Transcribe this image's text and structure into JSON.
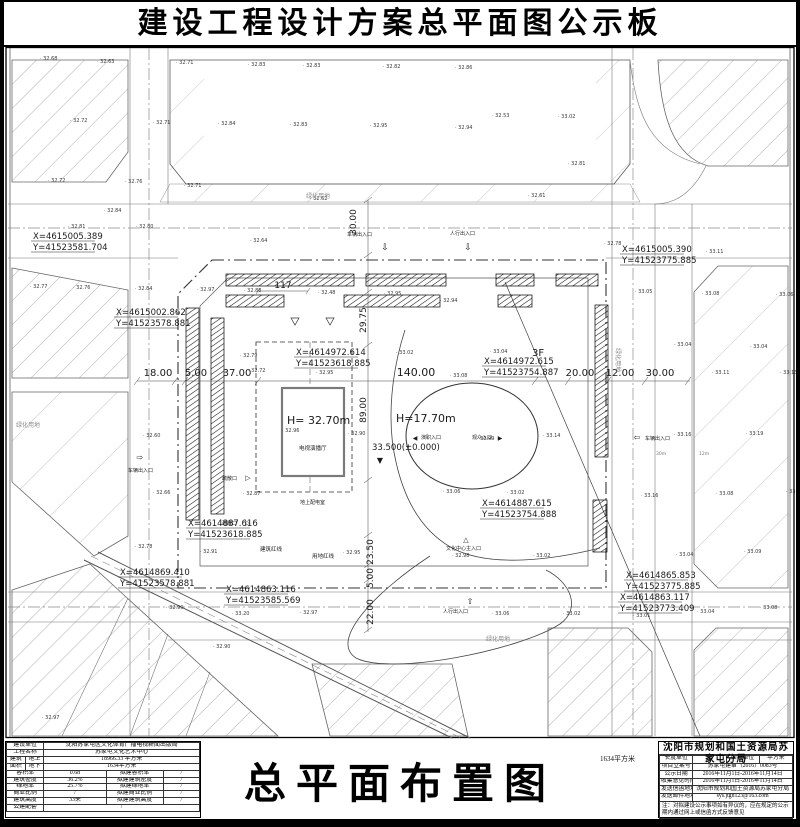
{
  "page": {
    "board_title": "建设工程设计方案总平面图公示板",
    "drawing_title": "总平面布置图",
    "stray_area_note": "1634平方米"
  },
  "left_table": {
    "rows": [
      {
        "cells": [
          {
            "t": "建设单位",
            "w": 2
          },
          {
            "t": "沈阳苏家屯区文化体育广播电视新闻出版局",
            "w": 3
          }
        ]
      },
      {
        "cells": [
          {
            "t": "工程名称",
            "w": 2
          },
          {
            "t": "苏家屯文化艺术中心",
            "w": 3
          }
        ]
      },
      {
        "cells": [
          {
            "t": "建筑",
            "w": 1
          },
          {
            "t": "地上",
            "w": 1
          },
          {
            "t": "18966.33 平方米",
            "w": 3
          }
        ]
      },
      {
        "cells": [
          {
            "t": "面积",
            "w": 1
          },
          {
            "t": "地下",
            "w": 1
          },
          {
            "t": "1634平方米",
            "w": 3
          }
        ]
      },
      {
        "cells": [
          {
            "t": "容积率",
            "w": 2
          },
          {
            "t": "0.68",
            "w": 1
          },
          {
            "t": "拟建容积率",
            "w": 1
          },
          {
            "t": "/",
            "w": 1
          }
        ]
      },
      {
        "cells": [
          {
            "t": "建筑密度",
            "w": 2
          },
          {
            "t": "36.2%",
            "w": 1
          },
          {
            "t": "拟建建筑密度",
            "w": 1
          },
          {
            "t": "/",
            "w": 1
          }
        ]
      },
      {
        "cells": [
          {
            "t": "绿地率",
            "w": 2
          },
          {
            "t": "25.7%",
            "w": 1
          },
          {
            "t": "拟建绿地率",
            "w": 1
          },
          {
            "t": "/",
            "w": 1
          }
        ]
      },
      {
        "cells": [
          {
            "t": "商业比例",
            "w": 2
          },
          {
            "t": "/",
            "w": 1
          },
          {
            "t": "拟建商业比例",
            "w": 1
          },
          {
            "t": "/",
            "w": 1
          }
        ]
      },
      {
        "cells": [
          {
            "t": "建筑高度",
            "w": 2
          },
          {
            "t": "33米",
            "w": 1
          },
          {
            "t": "拟建建筑高度",
            "w": 1
          },
          {
            "t": "/",
            "w": 1
          }
        ]
      },
      {
        "cells": [
          {
            "t": "公建配套",
            "w": 2
          },
          {
            "t": "/",
            "w": 3
          }
        ]
      }
    ]
  },
  "right_table": {
    "agency": "沈阳市规划和国土资源局苏家屯分局",
    "rows": [
      {
        "cells": [
          {
            "t": "长度单位",
            "w": 1
          },
          {
            "t": "米",
            "w": 1
          },
          {
            "t": "面积单位",
            "w": 1
          },
          {
            "t": "平方米",
            "w": 1
          }
        ]
      },
      {
        "cells": [
          {
            "t": "项目立案号",
            "w": 1
          },
          {
            "t": "苏家屯建审（2016）0083号",
            "w": 3
          }
        ]
      },
      {
        "cells": [
          {
            "t": "公示日期",
            "w": 1
          },
          {
            "t": "2016年11月1日-2016年11月14日",
            "w": 3
          }
        ]
      },
      {
        "cells": [
          {
            "t": "收集意见时间",
            "w": 1
          },
          {
            "t": "2016年11月1日-2016年11月14日",
            "w": 3
          }
        ]
      },
      {
        "cells": [
          {
            "t": "发送信函地址",
            "w": 1
          },
          {
            "t": "沈阳市规划和国土资源局苏家屯分局",
            "w": 3
          }
        ]
      },
      {
        "cells": [
          {
            "t": "发送邮件地址",
            "w": 1
          },
          {
            "t": "sys.jtgh123@163.com",
            "w": 3
          }
        ]
      }
    ],
    "note": "注：对拟建设公示事项如有异议的，应在规定的公示期内通过网上或信函方式反馈意见"
  },
  "site_plan": {
    "coordinate_callouts": [
      {
        "x": 33,
        "y": 239,
        "a": "X=4615005.389",
        "b": "Y=41523581.704"
      },
      {
        "x": 116,
        "y": 315,
        "a": "X=4615002.862",
        "b": "Y=41523578.881"
      },
      {
        "x": 296,
        "y": 355,
        "a": "X=4614972.614",
        "b": "Y=41523618.885"
      },
      {
        "x": 484,
        "y": 364,
        "a": "X=4614972.615",
        "b": "Y=41523754.887"
      },
      {
        "x": 622,
        "y": 252,
        "a": "X=4615005.390",
        "b": "Y=41523775.885"
      },
      {
        "x": 188,
        "y": 526,
        "a": "X=4614887.616",
        "b": "Y=41523618.885"
      },
      {
        "x": 120,
        "y": 575,
        "a": "X=4614869.410",
        "b": "Y=41523578.881"
      },
      {
        "x": 226,
        "y": 592,
        "a": "X=4614863.116",
        "b": "Y=41523585.569"
      },
      {
        "x": 482,
        "y": 506,
        "a": "X=4614887.615",
        "b": "Y=41523754.888"
      },
      {
        "x": 626,
        "y": 578,
        "a": "X=4614865.853",
        "b": "Y=41523775.885"
      },
      {
        "x": 620,
        "y": 600,
        "a": "X=4614863.117",
        "b": "Y=41523773.409"
      }
    ],
    "dimensions": [
      {
        "t": "18.00",
        "x": 158,
        "y": 376,
        "s": 10
      },
      {
        "t": "5.00",
        "x": 196,
        "y": 376,
        "s": 10
      },
      {
        "t": "37.00",
        "x": 237,
        "y": 376,
        "s": 10
      },
      {
        "t": "140.00",
        "x": 416,
        "y": 376,
        "s": 11
      },
      {
        "t": "20.00",
        "x": 580,
        "y": 376,
        "s": 10
      },
      {
        "t": "12.00",
        "x": 620,
        "y": 376,
        "s": 10
      },
      {
        "t": "30.00",
        "x": 660,
        "y": 376,
        "s": 10
      },
      {
        "t": "117",
        "x": 283,
        "y": 288,
        "s": 9
      },
      {
        "t": "30.00",
        "x": 356,
        "y": 222,
        "s": 9,
        "rot": -90
      },
      {
        "t": "29.75",
        "x": 366,
        "y": 320,
        "s": 9,
        "rot": -90
      },
      {
        "t": "89.00",
        "x": 366,
        "y": 410,
        "s": 9,
        "rot": -90
      },
      {
        "t": "23.50",
        "x": 373,
        "y": 552,
        "s": 9,
        "rot": -90
      },
      {
        "t": "5.00",
        "x": 373,
        "y": 578,
        "s": 9,
        "rot": -90
      },
      {
        "t": "22.00",
        "x": 373,
        "y": 612,
        "s": 9,
        "rot": -90
      }
    ],
    "labels": [
      {
        "t": "车辆出入口",
        "x": 347,
        "y": 236,
        "s": 5,
        "n": "vehicle-entrance-label",
        "icon": "⇩",
        "ix": 385,
        "iy": 250,
        "is": 9
      },
      {
        "t": "人行出入口",
        "x": 450,
        "y": 235,
        "s": 5,
        "n": "pedestrian-entrance-label",
        "icon": "⇩",
        "ix": 468,
        "iy": 250,
        "is": 9
      },
      {
        "t": "车辆出入口",
        "x": 128,
        "y": 472,
        "s": 5,
        "n": "vehicle-entrance-label",
        "icon": "⇨",
        "ix": 140,
        "iy": 460,
        "is": 8
      },
      {
        "t": "车辆出入口",
        "x": 645,
        "y": 440,
        "s": 5,
        "n": "vehicle-entrance-label",
        "icon": "⇦",
        "ix": 637,
        "iy": 440,
        "is": 8
      },
      {
        "t": "人行出入口",
        "x": 443,
        "y": 613,
        "s": 5,
        "n": "pedestrian-entrance-label",
        "icon": "⇧",
        "ix": 470,
        "iy": 604,
        "is": 8
      },
      {
        "t": "文化中心主入口",
        "x": 446,
        "y": 550,
        "s": 5,
        "n": "main-entrance-label",
        "icon": "△",
        "ix": 466,
        "iy": 542,
        "is": 7
      },
      {
        "t": "疏散口",
        "x": 222,
        "y": 480,
        "s": 5,
        "n": "evacuation-exit-label",
        "icon": "▷",
        "ix": 248,
        "iy": 480,
        "is": 7
      },
      {
        "t": "疏散口",
        "x": 222,
        "y": 525,
        "s": 5,
        "n": "evacuation-exit-label",
        "icon": "▷",
        "ix": 248,
        "iy": 525,
        "is": 7
      },
      {
        "t": "演职入口",
        "x": 421,
        "y": 439,
        "s": 5,
        "n": "performer-entrance-label",
        "icon": "◀",
        "ix": 415,
        "iy": 440,
        "is": 6
      },
      {
        "t": "观众入口",
        "x": 472,
        "y": 439,
        "s": 5,
        "n": "audience-entrance-label",
        "icon": "▶",
        "ix": 500,
        "iy": 440,
        "is": 6
      },
      {
        "t": "建筑红线",
        "x": 260,
        "y": 551,
        "s": 5.5,
        "n": "building-redline-label"
      },
      {
        "t": "用地红线",
        "x": 312,
        "y": 558,
        "s": 5.5,
        "n": "site-redline-label"
      },
      {
        "t": "绿化用地",
        "x": 306,
        "y": 198,
        "s": 6,
        "c": "#8c8c8c",
        "n": "green-land-label"
      },
      {
        "t": "绿化用地",
        "x": 16,
        "y": 427,
        "s": 6,
        "c": "#8c8c8c",
        "n": "green-land-label"
      },
      {
        "t": "绿化用地",
        "x": 616,
        "y": 348,
        "s": 6,
        "rot": 90,
        "c": "#8c8c8c",
        "n": "green-land-label"
      },
      {
        "t": "绿化用地",
        "x": 486,
        "y": 641,
        "s": 6,
        "c": "#8c8c8c",
        "n": "green-land-label"
      },
      {
        "t": "电视演播厅",
        "x": 299,
        "y": 450,
        "s": 5.5,
        "n": "studio-name-label"
      },
      {
        "t": "地上配电室",
        "x": 300,
        "y": 504,
        "s": 5,
        "n": "power-room-label"
      },
      {
        "t": "H= 32.70m",
        "x": 287,
        "y": 424,
        "s": 11,
        "n": "studio-height-label"
      },
      {
        "t": "H=17.70m",
        "x": 396,
        "y": 422,
        "s": 11,
        "n": "hall-height-label"
      },
      {
        "t": "33.500(±0.000)",
        "x": 372,
        "y": 450,
        "s": 8.5,
        "n": "level-label"
      },
      {
        "icon": "▼",
        "ix": 380,
        "iy": 463,
        "is": 8,
        "n": "level-marker"
      },
      {
        "t": "3F",
        "x": 532,
        "y": 356,
        "s": 10,
        "n": "floors-label"
      },
      {
        "t": "30m",
        "x": 656,
        "y": 455,
        "s": 4.5,
        "c": "#777",
        "n": "road-width-label"
      },
      {
        "t": "12m",
        "x": 699,
        "y": 455,
        "s": 4.5,
        "c": "#777",
        "n": "road-width-label"
      }
    ],
    "spot_elevations": [
      [
        40,
        60,
        "32.68"
      ],
      [
        97,
        63,
        "32.63"
      ],
      [
        70,
        122,
        "32.72"
      ],
      [
        48,
        182,
        "32.72"
      ],
      [
        125,
        183,
        "32.76"
      ],
      [
        68,
        228,
        "32.81"
      ],
      [
        136,
        228,
        "32.80"
      ],
      [
        30,
        288,
        "32.77"
      ],
      [
        73,
        289,
        "32.76"
      ],
      [
        135,
        290,
        "32.84"
      ],
      [
        176,
        64,
        "32.71"
      ],
      [
        248,
        66,
        "32.83"
      ],
      [
        303,
        67,
        "32.83"
      ],
      [
        383,
        68,
        "32.82"
      ],
      [
        455,
        69,
        "32.86"
      ],
      [
        218,
        125,
        "32.84"
      ],
      [
        290,
        126,
        "32.83"
      ],
      [
        370,
        127,
        "32.95"
      ],
      [
        455,
        129,
        "32.94"
      ],
      [
        492,
        117,
        "32.53"
      ],
      [
        558,
        118,
        "33.02"
      ],
      [
        568,
        165,
        "32.81"
      ],
      [
        184,
        187,
        "32.71"
      ],
      [
        310,
        200,
        "32.62"
      ],
      [
        528,
        197,
        "32.61"
      ],
      [
        153,
        124,
        "32.71"
      ],
      [
        250,
        242,
        "32.64"
      ],
      [
        604,
        245,
        "32.78"
      ],
      [
        706,
        253,
        "33.11"
      ],
      [
        635,
        293,
        "33.05"
      ],
      [
        702,
        295,
        "33.08"
      ],
      [
        776,
        296,
        "33.06"
      ],
      [
        674,
        346,
        "33.04"
      ],
      [
        750,
        348,
        "33.04"
      ],
      [
        712,
        374,
        "33.11"
      ],
      [
        780,
        374,
        "33.13"
      ],
      [
        746,
        435,
        "33.19"
      ],
      [
        674,
        436,
        "33.16"
      ],
      [
        641,
        497,
        "33.16"
      ],
      [
        716,
        495,
        "33.08"
      ],
      [
        786,
        493,
        "33.14"
      ],
      [
        676,
        556,
        "33.04"
      ],
      [
        744,
        553,
        "33.09"
      ],
      [
        197,
        291,
        "32.97"
      ],
      [
        244,
        292,
        "32.88"
      ],
      [
        318,
        294,
        "32.48"
      ],
      [
        384,
        295,
        "32.95"
      ],
      [
        440,
        302,
        "32.94"
      ],
      [
        240,
        357,
        "32.79"
      ],
      [
        248,
        372,
        "32.72"
      ],
      [
        316,
        374,
        "32.95"
      ],
      [
        282,
        432,
        "32.96"
      ],
      [
        348,
        435,
        "32.90"
      ],
      [
        396,
        354,
        "33.02"
      ],
      [
        490,
        353,
        "33.04"
      ],
      [
        450,
        377,
        "33.08"
      ],
      [
        477,
        440,
        "32.99"
      ],
      [
        543,
        437,
        "33.14"
      ],
      [
        443,
        493,
        "33.06"
      ],
      [
        507,
        494,
        "33.02"
      ],
      [
        243,
        495,
        "32.87"
      ],
      [
        153,
        494,
        "32.66"
      ],
      [
        143,
        437,
        "32.60"
      ],
      [
        200,
        553,
        "32.91"
      ],
      [
        343,
        554,
        "32.95"
      ],
      [
        135,
        548,
        "32.78"
      ],
      [
        166,
        609,
        "32.90"
      ],
      [
        232,
        615,
        "33.20"
      ],
      [
        300,
        614,
        "32.97"
      ],
      [
        452,
        557,
        "32.98"
      ],
      [
        533,
        557,
        "33.02"
      ],
      [
        492,
        615,
        "33.06"
      ],
      [
        563,
        615,
        "33.02"
      ],
      [
        633,
        617,
        "33.01"
      ],
      [
        697,
        613,
        "33.04"
      ],
      [
        760,
        609,
        "33.08"
      ],
      [
        42,
        719,
        "32.97"
      ],
      [
        213,
        648,
        "32.90"
      ],
      [
        104,
        212,
        "32.84"
      ]
    ]
  }
}
